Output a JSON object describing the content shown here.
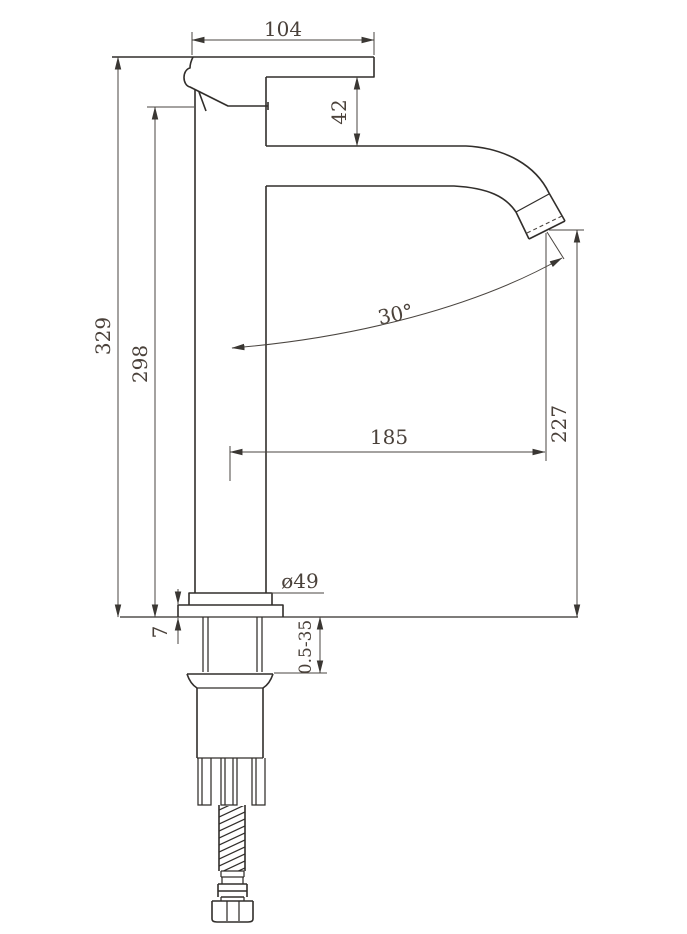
{
  "drawing": {
    "kind": "faucet side-elevation technical drawing",
    "dims": {
      "top_width": "104",
      "head_offset": "42",
      "overall_height": "329",
      "body_height": "298",
      "spout_angle": "30°",
      "spout_reach": "185",
      "outlet_height": "227",
      "base_diameter": "ø49",
      "flange_height": "7",
      "clamp_range": "0.5-35"
    }
  }
}
